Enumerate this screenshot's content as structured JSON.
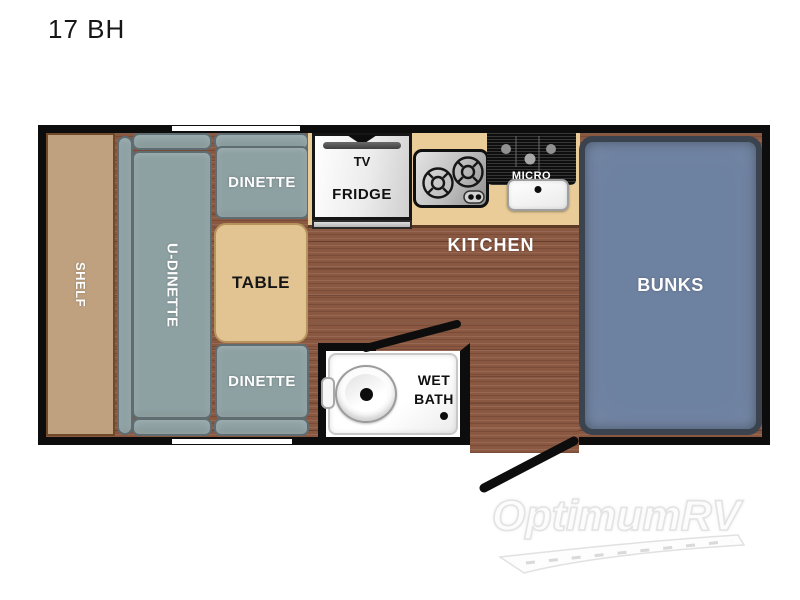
{
  "title": "17 BH",
  "plan": {
    "shelf": "SHELF",
    "u_dinette": "U-DINETTE",
    "dinette_top": "DINETTE",
    "table": "TABLE",
    "dinette_bottom": "DINETTE",
    "tv": "TV",
    "fridge": "FRIDGE",
    "micro": "MICRO",
    "kitchen": "KITCHEN",
    "wet": "WET",
    "bath": "BATH",
    "bunks": "BUNKS"
  },
  "watermark": {
    "brand": "OptimumRV"
  },
  "colors": {
    "wall": "#0d0d0d",
    "floor_wood": "#8a5741",
    "counter": "#e9cc97",
    "shelf": "#bfa180",
    "table": "#e2c493",
    "cushion": "#8da0a2",
    "mattress": "#6d81a0",
    "mattress_border": "#3b434e",
    "label_light": "#fdfdfd",
    "label_dark": "#161616"
  }
}
